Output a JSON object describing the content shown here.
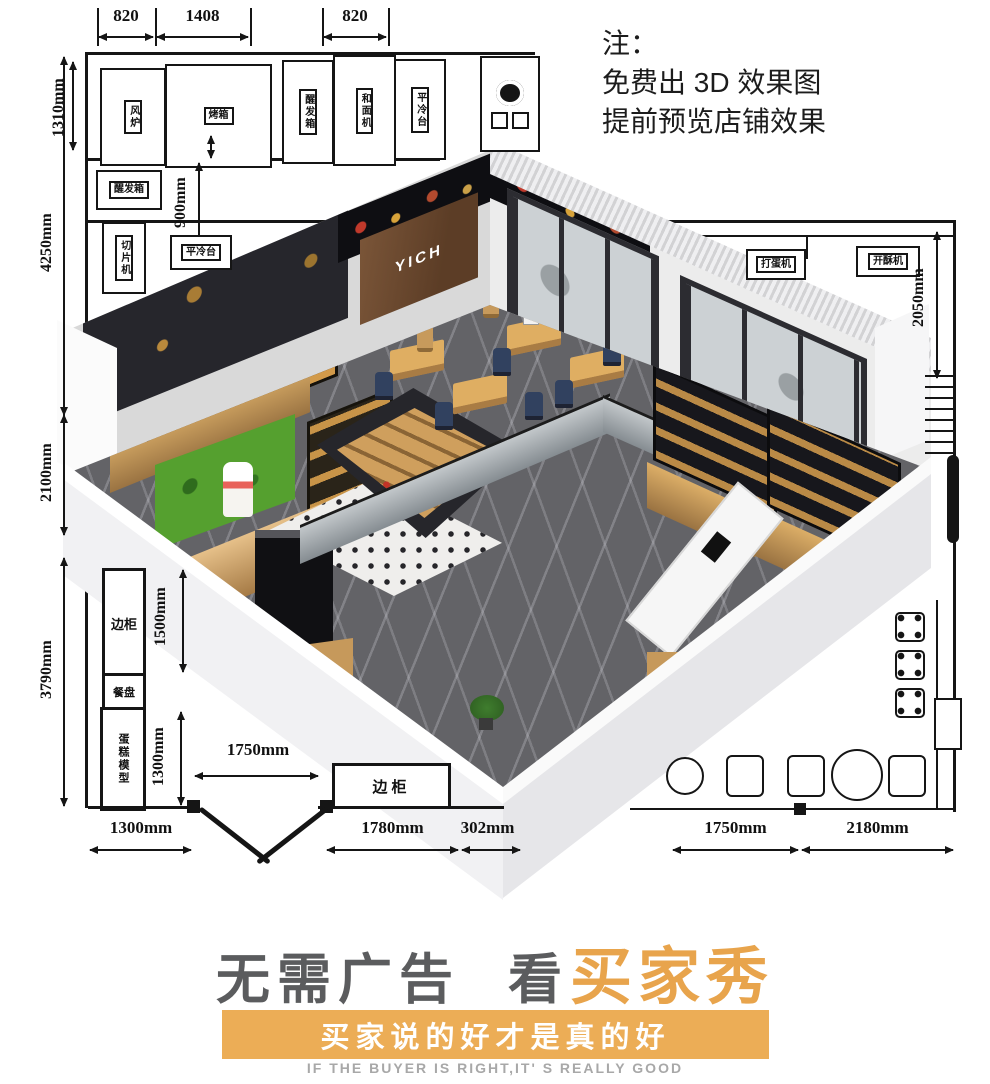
{
  "note": {
    "title": "注：",
    "line1": "免费出 3D 效果图",
    "line2": "提前预览店铺效果"
  },
  "plan": {
    "dims": {
      "t820l": "820",
      "t1408": "1408",
      "t820r": "820",
      "l1310": "1310mm",
      "l4250": "4250mm",
      "l2100": "2100mm",
      "l3790": "3790mm",
      "k900": "900mm",
      "r2050": "2050mm",
      "l1500": "1500mm",
      "l1300": "1300mm",
      "d1750": "1750mm",
      "b1300": "1300mm",
      "b1780": "1780mm",
      "b302": "302mm",
      "b1750": "1750mm",
      "b2180": "2180mm"
    },
    "labels": {
      "fan_oven": "风炉",
      "oven": "烤箱",
      "proofer_a": "醒发箱",
      "mixer": "和面机",
      "cold_table_a": "平冷台",
      "proofer_b": "醒发箱",
      "slicer": "切片机",
      "cold_table_b": "平冷台",
      "egg_beater": "打蛋机",
      "sheeter": "开酥机",
      "side_cab_left": "边柜",
      "tray": "餐盘",
      "cake_model": "蛋糕模型",
      "side_cab_bottom": "边柜"
    }
  },
  "render": {
    "sign": "YICH"
  },
  "footer": {
    "h_gray": "无需广告",
    "h_mid": "看",
    "h_gold": "买家秀",
    "banner": "买家说的好才是真的好",
    "english": "IF THE BUYER IS RIGHT,IT' S REALLY GOOD"
  },
  "colors": {
    "gold": "#E8A44C",
    "banner_gold": "#ECAD56",
    "headline_gray": "#5B5C5E"
  }
}
